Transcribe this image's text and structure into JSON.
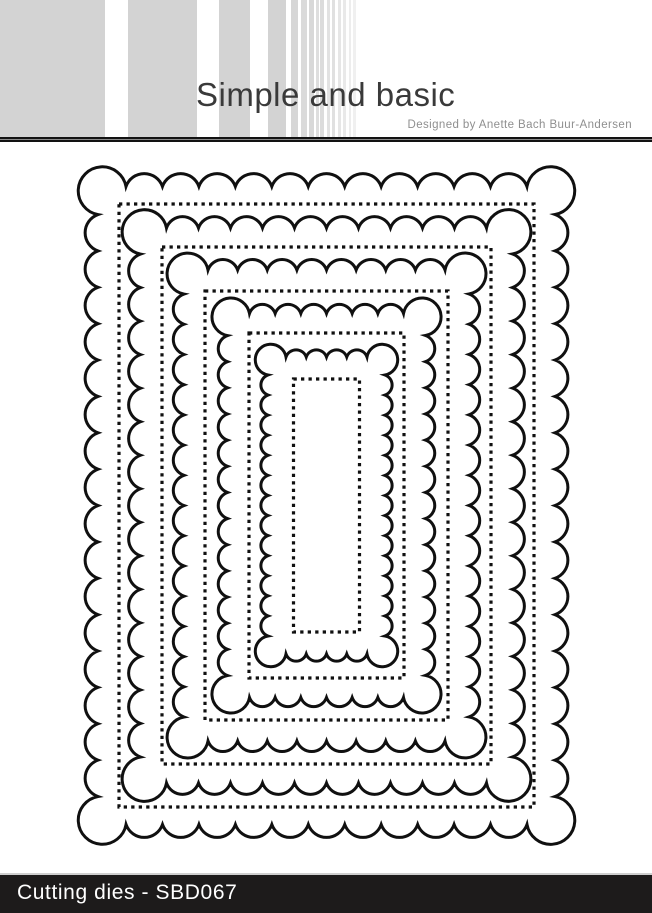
{
  "header": {
    "brand": "Simple and basic",
    "designer": "Designed by Anette Bach Buur-Andersen",
    "brand_color": "#3a3a3a",
    "designer_color": "#8f8f8f",
    "stripes": [
      {
        "x": 0,
        "w": 105,
        "color": "#d3d3d3"
      },
      {
        "x": 128,
        "w": 69,
        "color": "#d3d3d3"
      },
      {
        "x": 219,
        "w": 31,
        "color": "#d3d3d3"
      },
      {
        "x": 268,
        "w": 18,
        "color": "#d3d3d3"
      },
      {
        "x": 291,
        "w": 7,
        "color": "#d6d6d6"
      },
      {
        "x": 301,
        "w": 6,
        "color": "#dadada"
      },
      {
        "x": 309,
        "w": 5,
        "color": "#d8d8d8"
      },
      {
        "x": 316,
        "w": 3,
        "color": "#dedede"
      },
      {
        "x": 320,
        "w": 4,
        "color": "#dcdcdc"
      },
      {
        "x": 327,
        "w": 3,
        "color": "#e2e2e2"
      },
      {
        "x": 332,
        "w": 3,
        "color": "#e0e0e0"
      },
      {
        "x": 338,
        "w": 3,
        "color": "#e6e6e6"
      },
      {
        "x": 343,
        "w": 3,
        "color": "#e9e9e9"
      },
      {
        "x": 349,
        "w": 2,
        "color": "#ededed"
      },
      {
        "x": 353,
        "w": 3,
        "color": "#f0f0f0"
      }
    ]
  },
  "figure": {
    "type": "nested-scalloped-rectangle-cutting-dies",
    "description": "Five nested scalloped rectangle die outlines, each with an inner dotted stitch-line rectangle",
    "line_color": "#101010",
    "stroke_width": 3,
    "stitch_dash": [
      3.3,
      4.2
    ],
    "canvas": {
      "left": 60,
      "top": 150,
      "width": 533,
      "height": 711
    },
    "center": {
      "x": 266.5,
      "y": 355.5
    },
    "rings": [
      {
        "scallop": {
          "w": 482,
          "h": 663,
          "amplitude": 12.5,
          "corner": 28,
          "pitch": 37
        },
        "stitch": {
          "w": 415,
          "h": 603
        }
      },
      {
        "scallop": {
          "w": 396,
          "h": 579,
          "amplitude": 12,
          "corner": 26,
          "pitch": 33.5
        },
        "stitch": {
          "w": 329,
          "h": 517
        }
      },
      {
        "scallop": {
          "w": 308,
          "h": 494,
          "amplitude": 11.5,
          "corner": 24,
          "pitch": 30
        },
        "stitch": {
          "w": 243,
          "h": 429
        }
      },
      {
        "scallop": {
          "w": 220,
          "h": 406,
          "amplitude": 11,
          "corner": 22,
          "pitch": 26
        },
        "stitch": {
          "w": 155,
          "h": 345
        }
      },
      {
        "scallop": {
          "w": 135,
          "h": 315,
          "amplitude": 9,
          "corner": 18,
          "pitch": 20.5
        },
        "stitch": {
          "w": 66,
          "h": 253
        }
      }
    ]
  },
  "footer": {
    "label": "Cutting dies - SBD067",
    "bg_color": "#1d1b1b",
    "text_color": "#ffffff"
  }
}
